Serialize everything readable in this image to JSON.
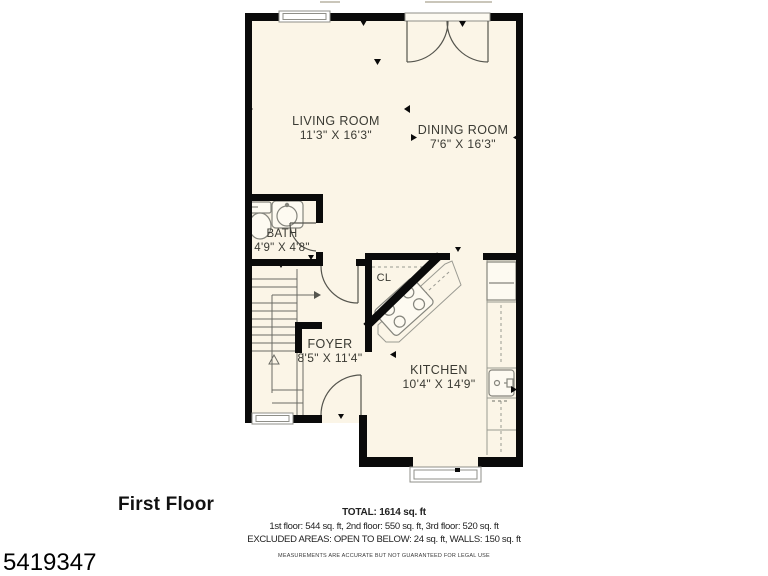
{
  "floor_title": "First Floor",
  "listing_id": "5419347",
  "rooms": {
    "living": {
      "name": "LIVING ROOM",
      "dims": "11'3\" X 16'3\""
    },
    "dining": {
      "name": "DINING ROOM",
      "dims": "7'6\" X 16'3\""
    },
    "bath": {
      "name": "BATH",
      "dims": "4'9\" X 4'8\""
    },
    "closet": {
      "name": "CL"
    },
    "foyer": {
      "name": "FOYER",
      "dims": "8'5\" X 11'4\""
    },
    "kitchen": {
      "name": "KITCHEN",
      "dims": "10'4\" X 14'9\""
    }
  },
  "summary": {
    "total": "TOTAL: 1614 sq. ft",
    "floors": "1st floor: 544 sq. ft, 2nd floor: 550 sq. ft, 3rd floor: 520 sq. ft",
    "excluded": "EXCLUDED AREAS: OPEN TO BELOW: 24 sq. ft, WALLS: 150 sq. ft",
    "disclaimer": "MEASUREMENTS ARE ACCURATE BUT NOT GUARANTEED FOR LEGAL USE"
  },
  "colors": {
    "floor_fill": "#FBF5E7",
    "wall": "#0A0A0A",
    "fixture_line": "#85857D",
    "door_line": "#55554E"
  }
}
